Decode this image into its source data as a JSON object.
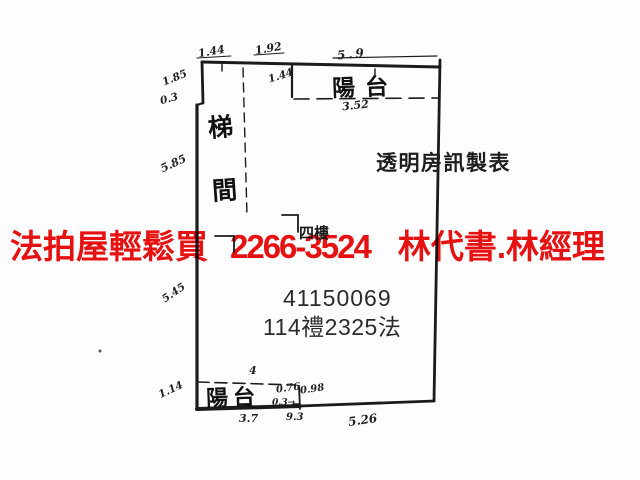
{
  "banner": {
    "left": "法拍屋輕鬆買",
    "phone": "2266-3524",
    "right": "林代書.林經理",
    "color": "#e81111"
  },
  "plan": {
    "balcony_top_label": "陽台",
    "balcony_bottom_label": "陽台",
    "stair_char_top": "梯",
    "stair_char_bottom": "間",
    "maker_label": "透明房訊製表",
    "case_number": "41150069",
    "case_id": "114禮2325法",
    "obscured_text": "四樓",
    "line_color": "#1b1b1b",
    "dims": [
      {
        "text": "1.44"
      },
      {
        "text": "1.92"
      },
      {
        "text": "5.9"
      },
      {
        "text": "1.85"
      },
      {
        "text": "0.3"
      },
      {
        "text": "1.44"
      },
      {
        "text": "3.52"
      },
      {
        "text": "5.85"
      },
      {
        "text": "5.45"
      },
      {
        "text": "1.14"
      },
      {
        "text": "4"
      },
      {
        "text": "0.76"
      },
      {
        "text": "0.98"
      },
      {
        "text": "0.3→"
      },
      {
        "text": "9.3"
      },
      {
        "text": "3.7"
      },
      {
        "text": "5.26"
      }
    ]
  }
}
